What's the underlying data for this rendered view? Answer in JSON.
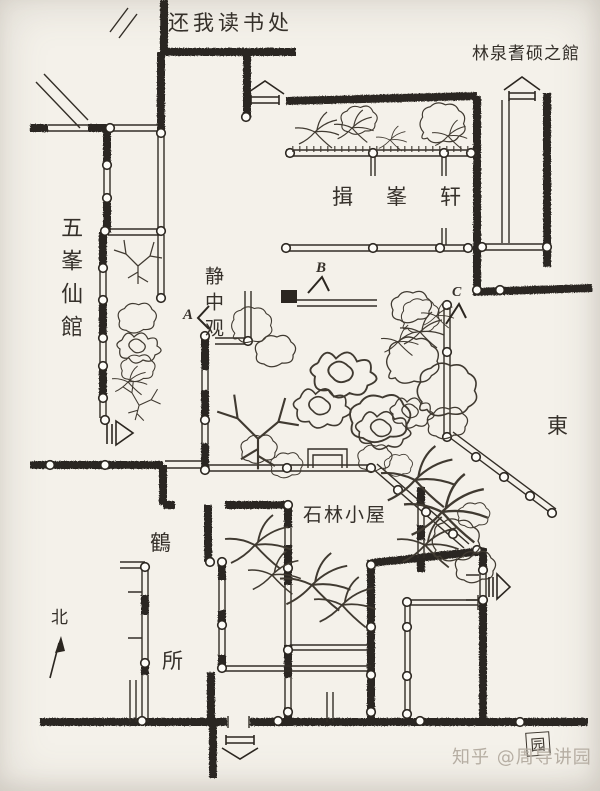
{
  "palette": {
    "paper": "#f4f1ea",
    "ink": "#2b2620",
    "watermark_gray": "#b6aea3"
  },
  "plan": {
    "type": "hand-drawn garden architecture plan",
    "labels": {
      "reading_place": "还我读书处",
      "linquan_hall": "林泉耆硕之館",
      "yifeng_xuan": "揖峯轩",
      "wufeng_hall": "五峯仙館",
      "jingzhong_guan": "静中观",
      "shilin_cottage": "石林小屋",
      "crane_he": "鶴",
      "crane_suo": "所",
      "east": "東",
      "north": "北"
    },
    "view_markers": {
      "a": "A",
      "b": "B",
      "c": "C"
    },
    "seal": "园",
    "watermark": "知乎 @周导讲园"
  }
}
